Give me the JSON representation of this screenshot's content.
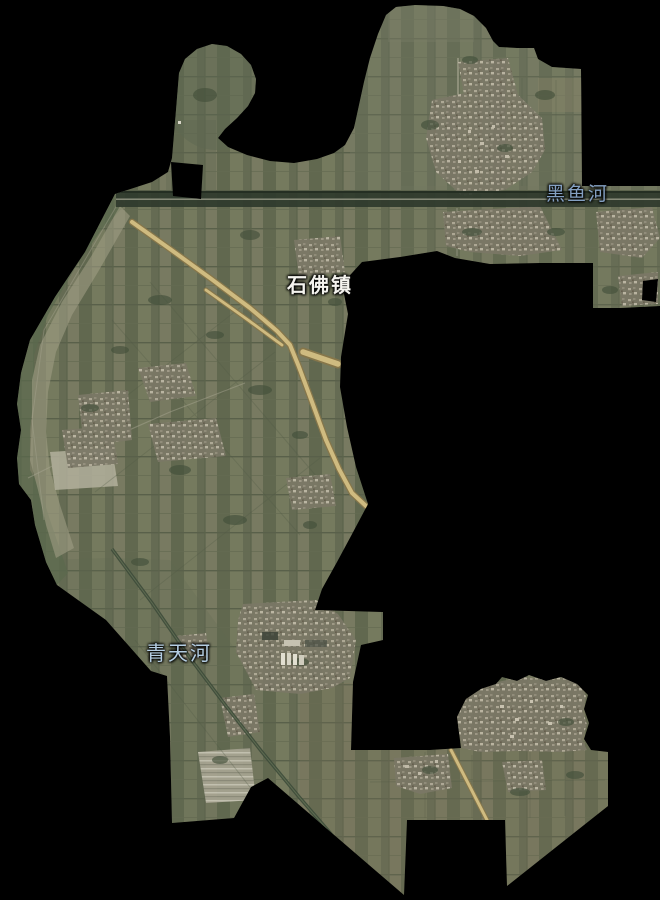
{
  "window": {
    "width": 660,
    "height": 900,
    "background": "#000000"
  },
  "map": {
    "kind": "satellite-township-boundary-map",
    "region_name": "石佛镇",
    "labels": [
      {
        "id": "town-shifo",
        "text": "石佛镇",
        "category": "town",
        "color": "#f4f3ee",
        "x": 287,
        "y": 275,
        "font_size": 20,
        "bold": true
      },
      {
        "id": "river-heiyu",
        "text": "黑鱼河",
        "category": "river",
        "color": "#84a0c2",
        "x": 546,
        "y": 185,
        "font_size": 19,
        "bold": false
      },
      {
        "id": "river-qingtian",
        "text": "青天河",
        "category": "river",
        "color": "#b4cde2",
        "x": 146,
        "y": 643,
        "font_size": 20,
        "bold": false
      }
    ],
    "palette": {
      "outside": "#000000",
      "land_base": "#6d7259",
      "land_light": "#7c7e64",
      "land_dark": "#5a614a",
      "sand": "#b3b09c",
      "village": "#8f8a79",
      "highway_fill": "#cfbb80",
      "highway_edge": "#86764a",
      "tree_road": "#3d4b3a",
      "road_band": "#2f3a2d"
    }
  }
}
